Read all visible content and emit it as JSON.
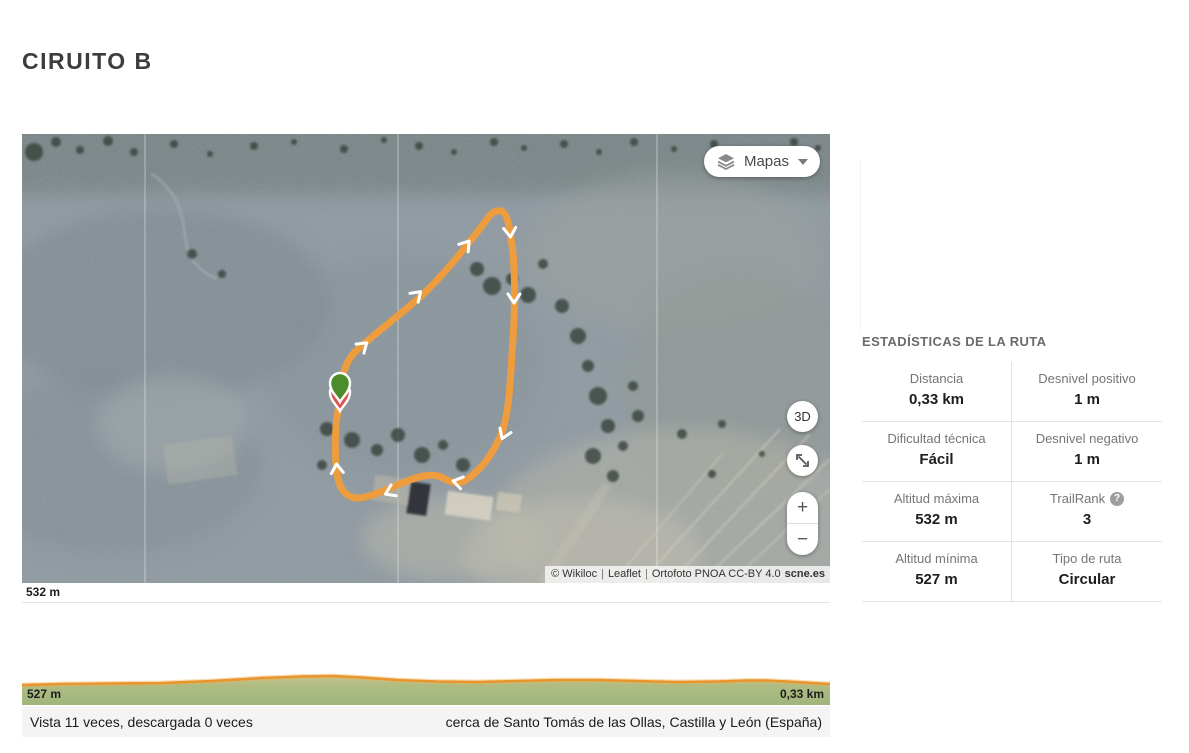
{
  "page": {
    "title": "CIRUITO B"
  },
  "map": {
    "layers_button": {
      "label": "Mapas"
    },
    "controls": {
      "view_3d": "3D",
      "zoom_in": "+",
      "zoom_out": "−"
    },
    "attribution": {
      "wikiloc": "© Wikiloc",
      "sep": "|",
      "leaflet": "Leaflet",
      "ortofoto": "Ortofoto PNOA CC-BY 4.0",
      "scne": "scne.es"
    }
  },
  "elevation": {
    "max_label": "532 m",
    "min_label": "527 m",
    "distance_label": "0,33 km"
  },
  "footer": {
    "views": "Vista 11 veces, descargada 0 veces",
    "location": "cerca de Santo Tomás de las Ollas, Castilla y León (España)"
  },
  "stats": {
    "heading": "ESTADÍSTICAS DE LA RUTA",
    "help_glyph": "?",
    "items": [
      {
        "label": "Distancia",
        "value": "0,33 km"
      },
      {
        "label": "Desnivel positivo",
        "value": "1 m"
      },
      {
        "label": "Dificultad técnica",
        "value": "Fácil"
      },
      {
        "label": "Desnivel negativo",
        "value": "1 m"
      },
      {
        "label": "Altitud máxima",
        "value": "532 m"
      },
      {
        "label": "TrailRank",
        "value": "3"
      },
      {
        "label": "Altitud mínima",
        "value": "527 m"
      },
      {
        "label": "Tipo de ruta",
        "value": "Circular"
      }
    ]
  },
  "colors": {
    "route_orange": "#ED9C3E",
    "elevation_green": "#A3B981",
    "marker_green": "#4C8C2B",
    "marker_red": "#D9534F"
  }
}
